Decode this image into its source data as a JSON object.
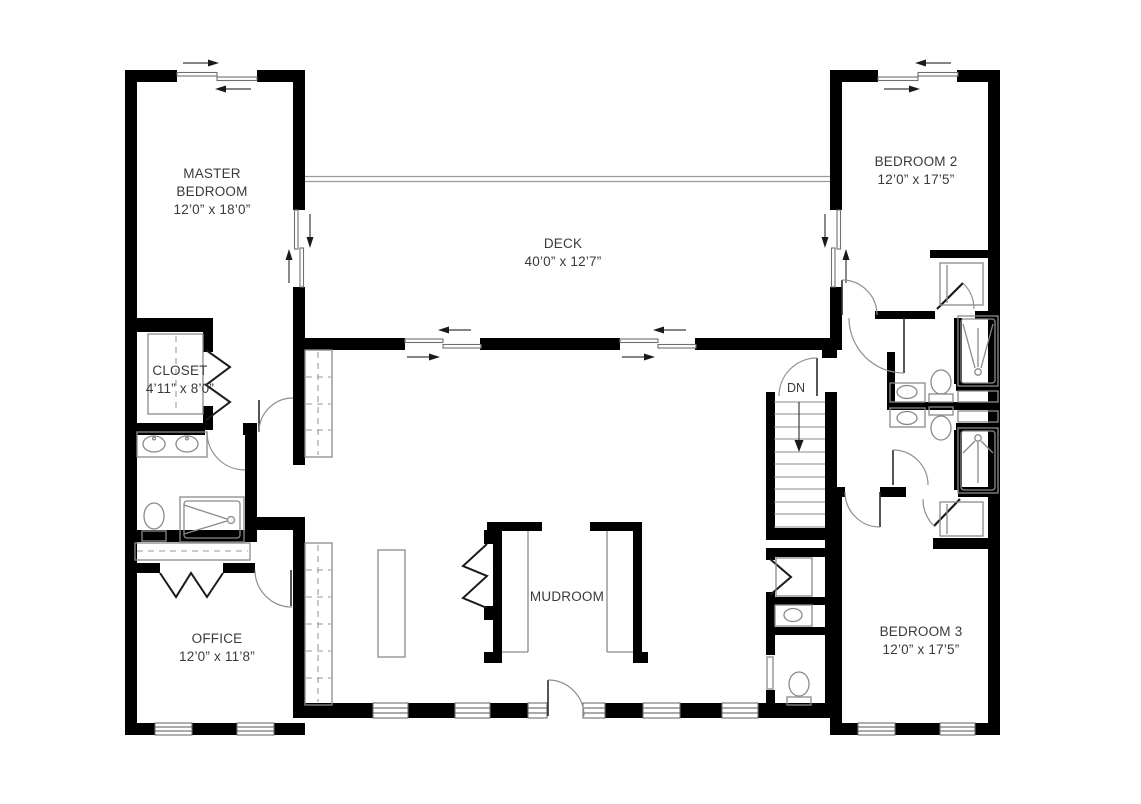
{
  "plan": {
    "rooms": {
      "master_bedroom": {
        "name": "MASTER BEDROOM",
        "dimensions": "12’0” x 18’0”"
      },
      "bedroom_2": {
        "name": "BEDROOM 2",
        "dimensions": "12’0” x 17’5”"
      },
      "bedroom_3": {
        "name": "BEDROOM 3",
        "dimensions": "12’0” x 17’5”"
      },
      "deck": {
        "name": "DECK",
        "dimensions": "40’0” x 12’7”"
      },
      "closet": {
        "name": "CLOSET",
        "dimensions": "4’11” x 8’0”"
      },
      "office": {
        "name": "OFFICE",
        "dimensions": "12’0” x 11’8”"
      },
      "mudroom": {
        "name": "MUDROOM"
      }
    },
    "stairs": {
      "label": "DN",
      "direction": "down"
    },
    "colors": {
      "wall": "#000000",
      "fixture_line": "#8a8a8a",
      "window_line": "#777777",
      "text": "#3a3a3a",
      "background": "#ffffff"
    }
  }
}
